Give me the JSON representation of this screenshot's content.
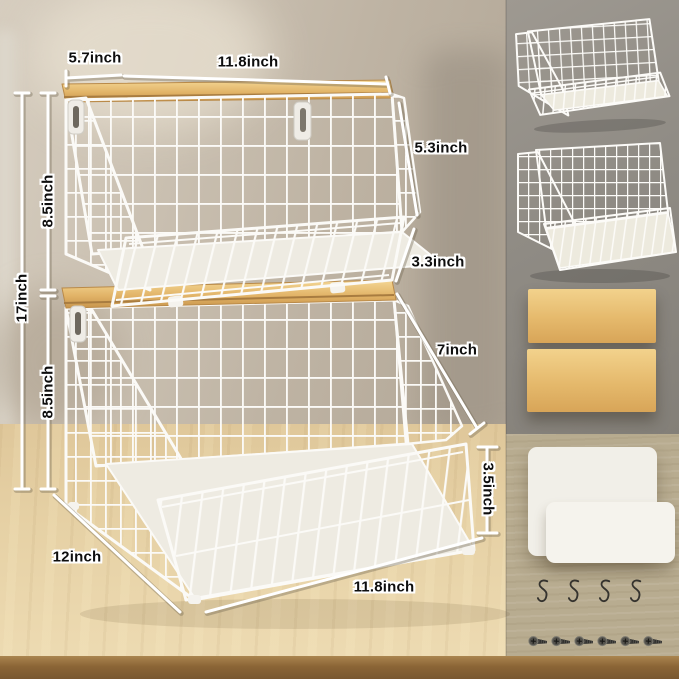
{
  "annotations": {
    "top_depth": "5.7inch",
    "top_width": "11.8inch",
    "total_height": "17inch",
    "upper_tier_height": "8.5inch",
    "lower_tier_height": "8.5inch",
    "upper_tier_slope": "5.3inch",
    "upper_tier_front_height": "3.3inch",
    "lower_tier_slope": "7inch",
    "lower_tier_front_height": "3.5inch",
    "base_depth": "12inch",
    "base_width": "11.8inch"
  },
  "right_panel": {
    "basket_images": [
      "stackable-wire-basket-upper",
      "stackable-wire-basket-lower"
    ],
    "bamboo_board_count": 2,
    "liner_mat_count": 2,
    "s_hook_count": 4,
    "screw_count": 6
  },
  "colors": {
    "wire": "#fbfaf7",
    "bamboo_light": "#f2d28c",
    "bamboo_dark": "#d8a558",
    "label_text": "#0e0e0e",
    "label_halo": "#ffffff",
    "wall": "#c6bcae",
    "table_wood": "#e6d1a5",
    "table_edge": "#8b6536",
    "right_panel_top_bg": "#908c85",
    "right_panel_bottom_bg": "#b8ac90",
    "mat": "#f1efe8",
    "hardware": "#35332e"
  }
}
